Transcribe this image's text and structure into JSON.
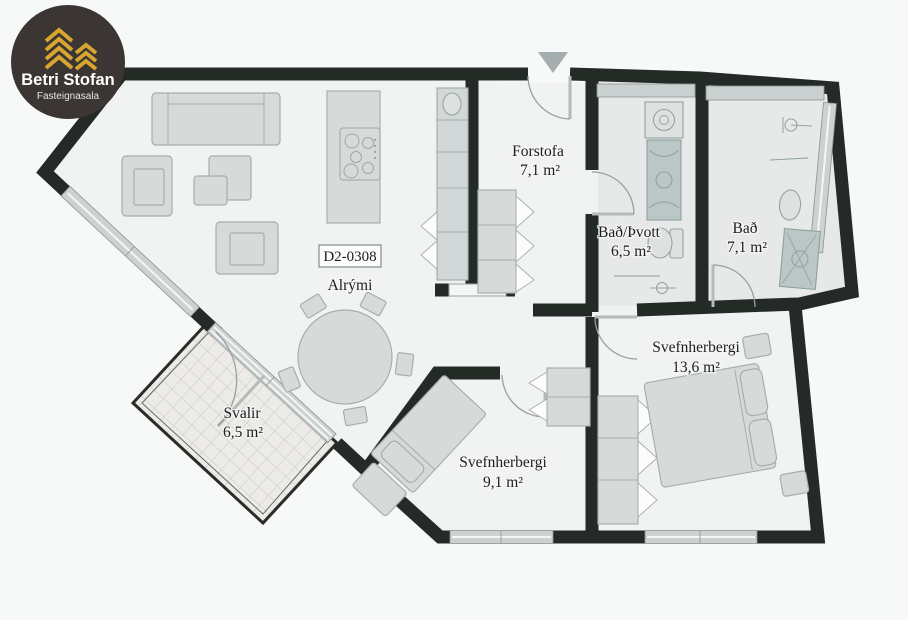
{
  "logo": {
    "brand": "Betri Stofan",
    "tagline": "Fasteignasala"
  },
  "unit": {
    "code": "D2-0308"
  },
  "rooms": {
    "forstofa": {
      "name": "Forstofa",
      "area": "7,1 m²"
    },
    "bad_thvott": {
      "name": "Bað/Þvott",
      "area": "6,5 m²"
    },
    "bad": {
      "name": "Bað",
      "area": "7,1 m²"
    },
    "svefnherbergi_big": {
      "name": "Svefnherbergi",
      "area": "13,6 m²"
    },
    "svefnherbergi_small": {
      "name": "Svefnherbergi",
      "area": "9,1 m²"
    },
    "svalir": {
      "name": "Svalir",
      "area": "6,5 m²"
    },
    "alrymi": {
      "name": "Alrými"
    }
  },
  "colors": {
    "wall": "#242b27",
    "floor": "#f1f3f2",
    "bath_floor": "#e6e9e8",
    "logo_bg": "#3b3633",
    "logo_gold": "#d8a62e",
    "glass": "#ccd2d1",
    "background": "#f7f8f8"
  }
}
